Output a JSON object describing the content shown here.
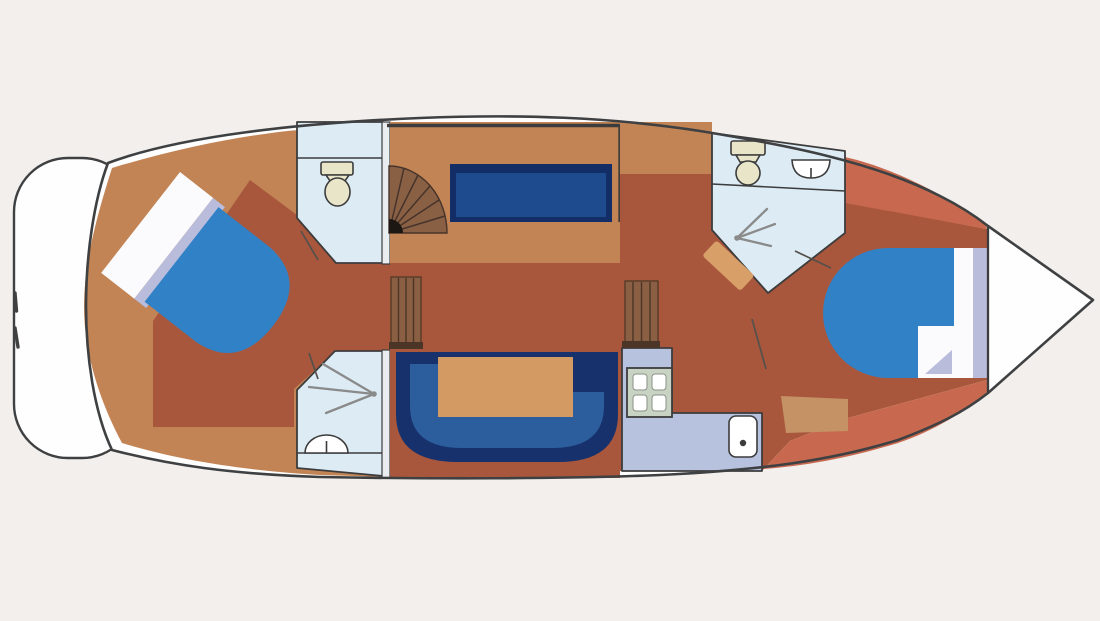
{
  "scene": {
    "subject": "motor-yacht interior deck plan, top view",
    "orientation": "bow pointing right, stern swim platform on left"
  },
  "colors": {
    "background": "#f2efec",
    "hull_white": "#fefefe",
    "outline": "#3e4042",
    "aft_cabin_floor": "#c28455",
    "walkway_floor": "#a8573d",
    "forward_cabin_floor": "#c8694f",
    "bathroom_floor": "#dcebf4",
    "galley_counter": "#b7c3de",
    "wall_fill": "#e9edf0",
    "sofa_navy": "#16316b",
    "sofa_inner": "#2c5d9c",
    "bench_navy": "#132e66",
    "bench_inner": "#1e4b8d",
    "table_wood": "#d39a63",
    "bed_blanket": "#3181c6",
    "pillow_white": "#fbfbfd",
    "pillow_shadow": "#b9bcdb",
    "stairs_wood": "#8a6045",
    "stairs_line": "#46332a",
    "ladder_wood": "#8a5f43",
    "ladder_line": "#4a3526",
    "fixture_beige": "#e9e5c9",
    "fixture_white": "#ffffff",
    "fixture_stroke": "#3c3c3c",
    "stove_frame": "#c9d3c3",
    "wall_line": "#3c3c3c",
    "door_line": "#55504b",
    "shower_line": "#8a8a8a",
    "step_wood": "#d99f68",
    "shelf_wood": "#c49265"
  },
  "regions": [
    {
      "id": "swim-platform",
      "role": "stern swim platform with boarding ladder marks"
    },
    {
      "id": "aft-cabin",
      "role": "aft cabin with diagonal double berth"
    },
    {
      "id": "aft-toilet-room",
      "role": "aft head compartment with toilet"
    },
    {
      "id": "aft-shower-room",
      "role": "aft shower compartment with washbasin"
    },
    {
      "id": "saloon",
      "role": "saloon with spiral stairs, bench seat, U-shaped sofa and table"
    },
    {
      "id": "galley",
      "role": "L-shaped galley with four-burner stove and sink"
    },
    {
      "id": "forward-head",
      "role": "forward head with toilet, washbasin and shower"
    },
    {
      "id": "forward-cabin",
      "role": "forward cabin with double berth and shelf"
    },
    {
      "id": "bow",
      "role": "pointed bow locker"
    }
  ]
}
